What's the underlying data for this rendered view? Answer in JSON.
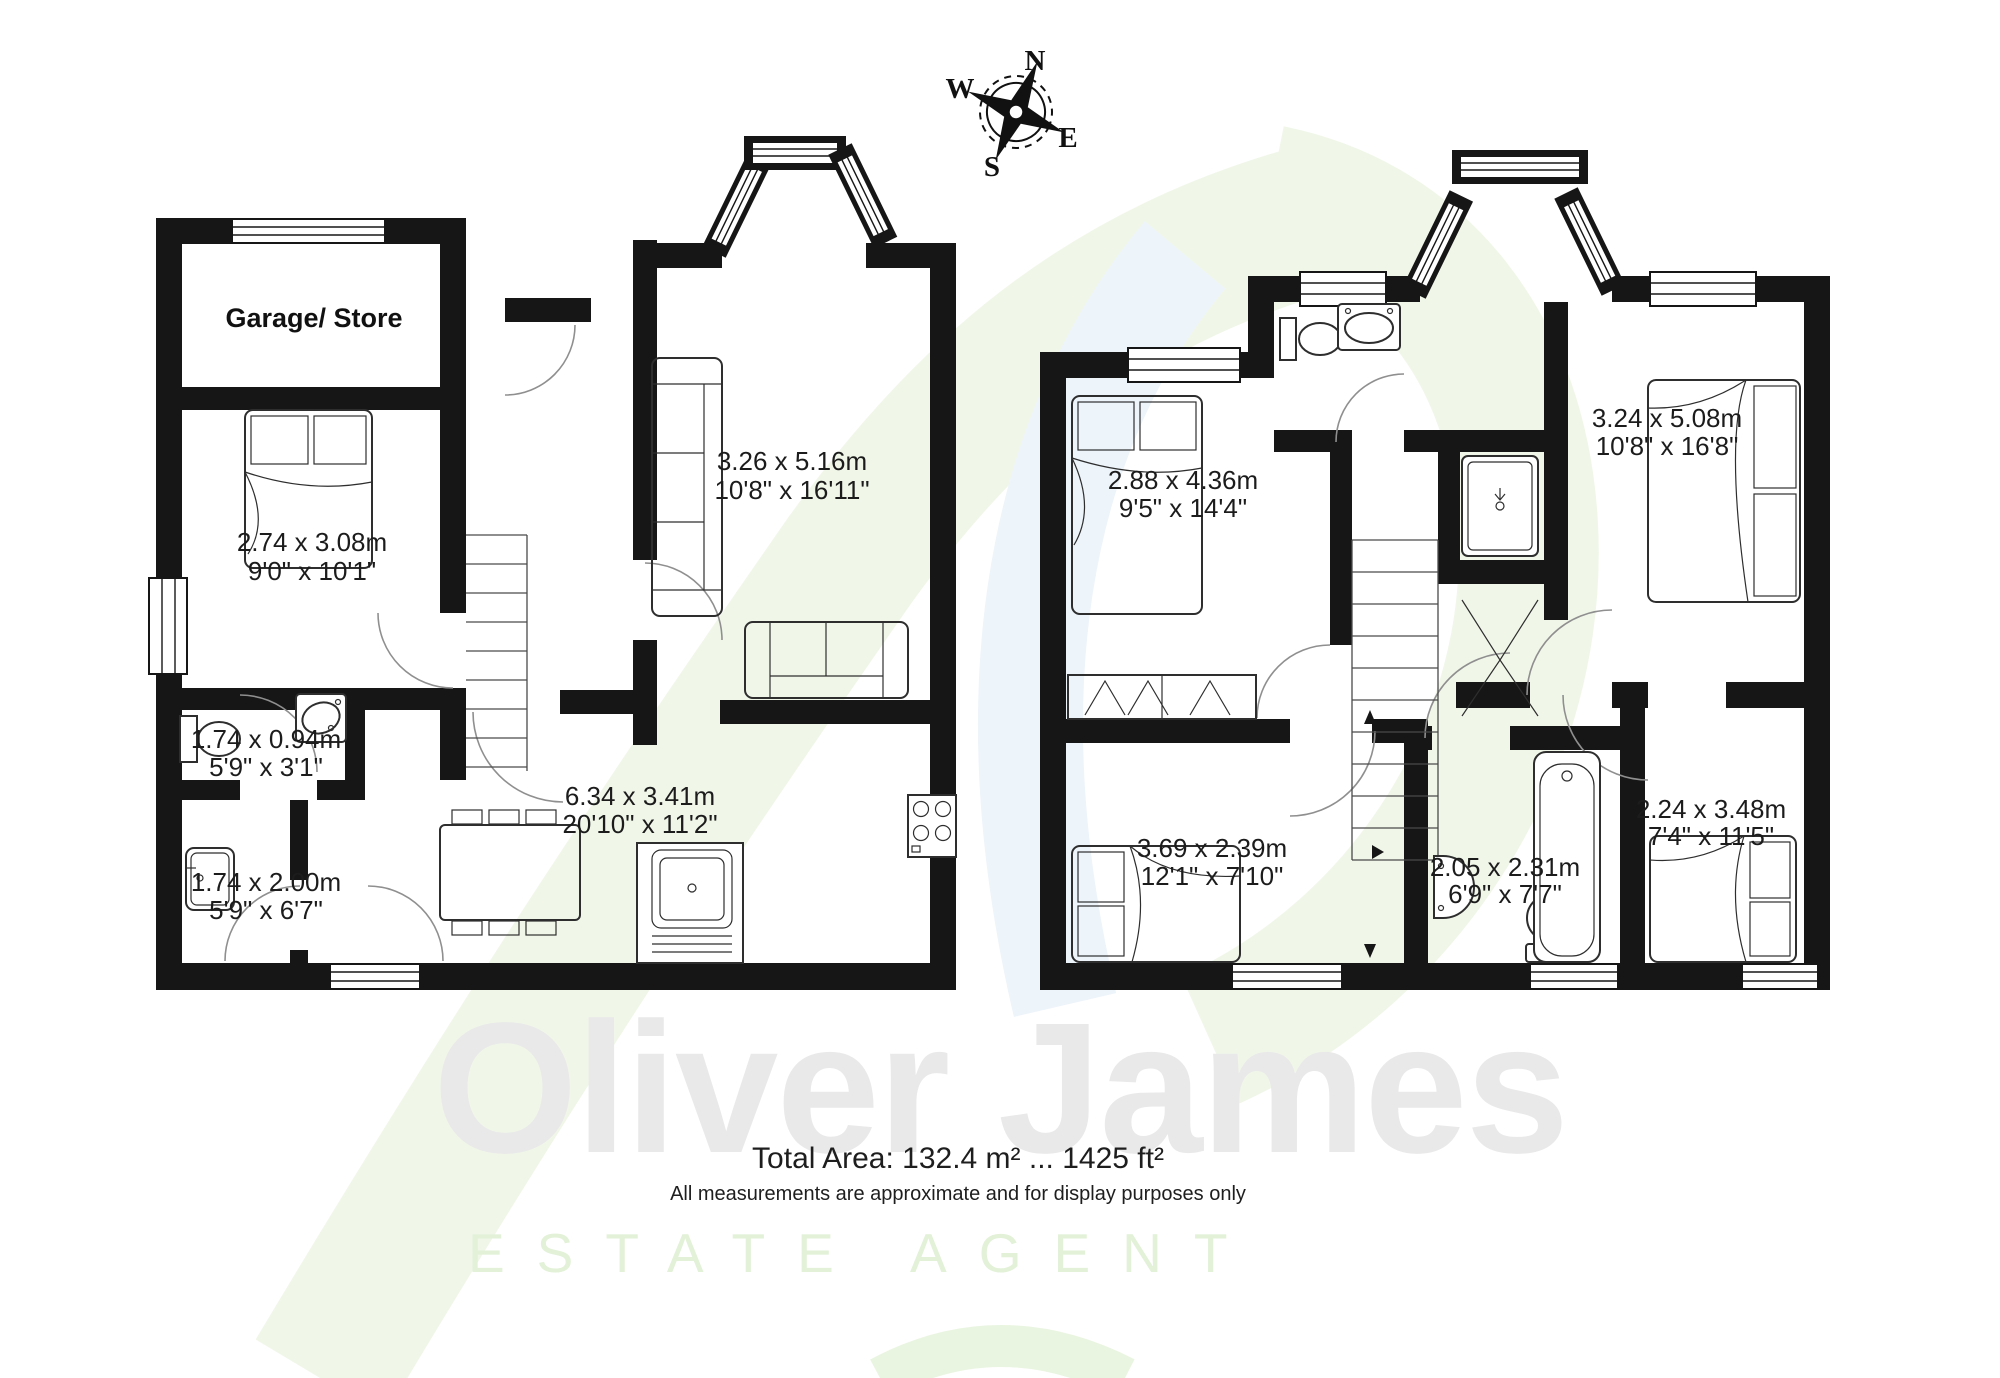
{
  "compass": {
    "n": "N",
    "e": "E",
    "s": "S",
    "w": "W"
  },
  "ground_floor": {
    "rooms": [
      {
        "id": "garage",
        "label": "Garage/ Store"
      },
      {
        "id": "bedroom",
        "metric": "2.74 x 3.08m",
        "imperial": "9'0\" x 10'1\""
      },
      {
        "id": "wc",
        "metric": "1.74 x 0.94m",
        "imperial": "5'9\" x 3'1\""
      },
      {
        "id": "shower-room",
        "metric": "1.74 x 2.00m",
        "imperial": "5'9\" x 6'7\""
      },
      {
        "id": "living-room",
        "metric": "3.26 x 5.16m",
        "imperial": "10'8\" x 16'11\""
      },
      {
        "id": "kitchen-diner",
        "metric": "6.34 x 3.41m",
        "imperial": "20'10\" x 11'2\""
      }
    ]
  },
  "first_floor": {
    "rooms": [
      {
        "id": "bedroom-1",
        "metric": "2.88 x 4.36m",
        "imperial": "9'5\" x 14'4\""
      },
      {
        "id": "bedroom-2",
        "metric": "3.24 x 5.08m",
        "imperial": "10'8\" x 16'8\""
      },
      {
        "id": "bedroom-3",
        "metric": "3.69 x 2.39m",
        "imperial": "12'1\" x 7'10\""
      },
      {
        "id": "bathroom",
        "metric": "2.05 x 2.31m",
        "imperial": "6'9\" x 7'7\""
      },
      {
        "id": "bedroom-4",
        "metric": "2.24 x 3.48m",
        "imperial": "7'4\" x 11'5\""
      }
    ]
  },
  "footer": {
    "total_area": "Total Area: 132.4 m² ... 1425 ft²",
    "disclaimer": "All measurements are approximate and for display purposes only"
  },
  "watermark": {
    "brand": "Oliver James",
    "tagline": "ESTATE AGENT"
  },
  "colors": {
    "wall": "#161616",
    "watermark_gray": "#e9e9e9",
    "watermark_green": "#e2f1d7",
    "swoosh_green": "#f0f7e9",
    "swoosh_blue": "#edf4fa"
  }
}
